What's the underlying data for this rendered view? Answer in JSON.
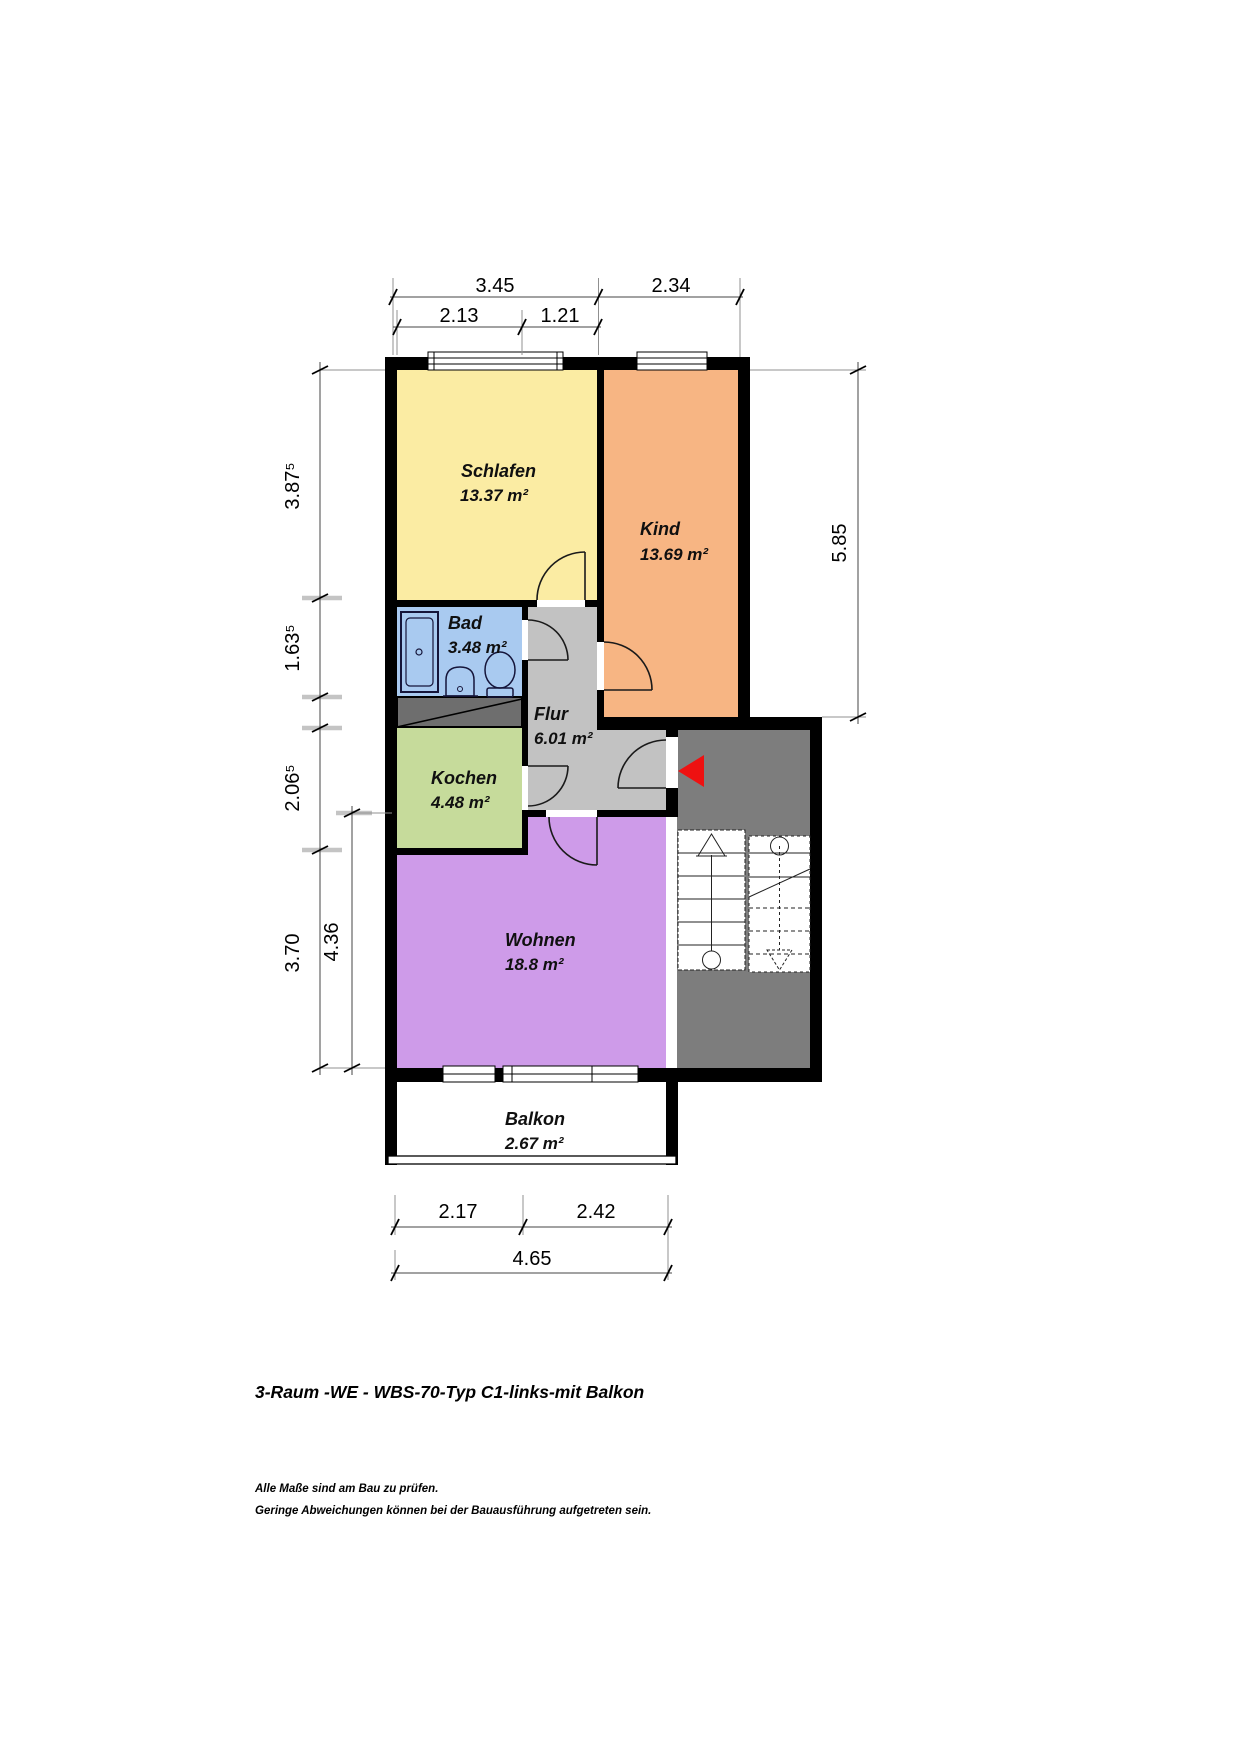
{
  "page": {
    "title": "3-Raum -WE - WBS-70-Typ C1-links-mit Balkon",
    "footer_line1": "Alle Maße sind am Bau zu prüfen.",
    "footer_line2": "Geringe Abweichungen können bei der Bauausführung aufgetreten sein."
  },
  "rooms": [
    {
      "name": "Schlafen",
      "area": "13.37 m²",
      "color": "#fbeca3"
    },
    {
      "name": "Kind",
      "area": "13.69 m²",
      "color": "#f7b583"
    },
    {
      "name": "Bad",
      "area": "3.48 m²",
      "color": "#a9caf0"
    },
    {
      "name": "Flur",
      "area": "6.01 m²",
      "color": "#c2c2c2"
    },
    {
      "name": "Kochen",
      "area": "4.48 m²",
      "color": "#c6db9b"
    },
    {
      "name": "Wohnen",
      "area": "18.8 m²",
      "color": "#ce9be9"
    },
    {
      "name": "Balkon",
      "area": "2.67 m²",
      "color": "#ffffff"
    }
  ],
  "dims": {
    "top_row1": [
      "3.45",
      "2.34"
    ],
    "top_row2": [
      "2.13",
      "1.21"
    ],
    "left_outer": [
      "3.87⁵",
      "1.63⁵",
      "2.06⁵",
      "3.70"
    ],
    "left_inner": "4.36",
    "right": "5.85",
    "bottom_row1": [
      "2.17",
      "2.42"
    ],
    "bottom_row2": "4.65"
  },
  "colors": {
    "wall": "#000000",
    "stairwell": "#7d7d7d",
    "shaft": "#6e6e6e",
    "entrance_arrow": "#ee1111"
  },
  "icons": {
    "entrance-arrow-icon": "filled triangle pointing left",
    "shower-icon": "shower tray",
    "washbasin-icon": "washbasin",
    "toilet-icon": "toilet",
    "stairs-up-icon": "staircase flight with up arrow",
    "stairs-down-icon": "dashed staircase flight with down arrow",
    "door-swing-icon": "quarter-circle door swing"
  }
}
